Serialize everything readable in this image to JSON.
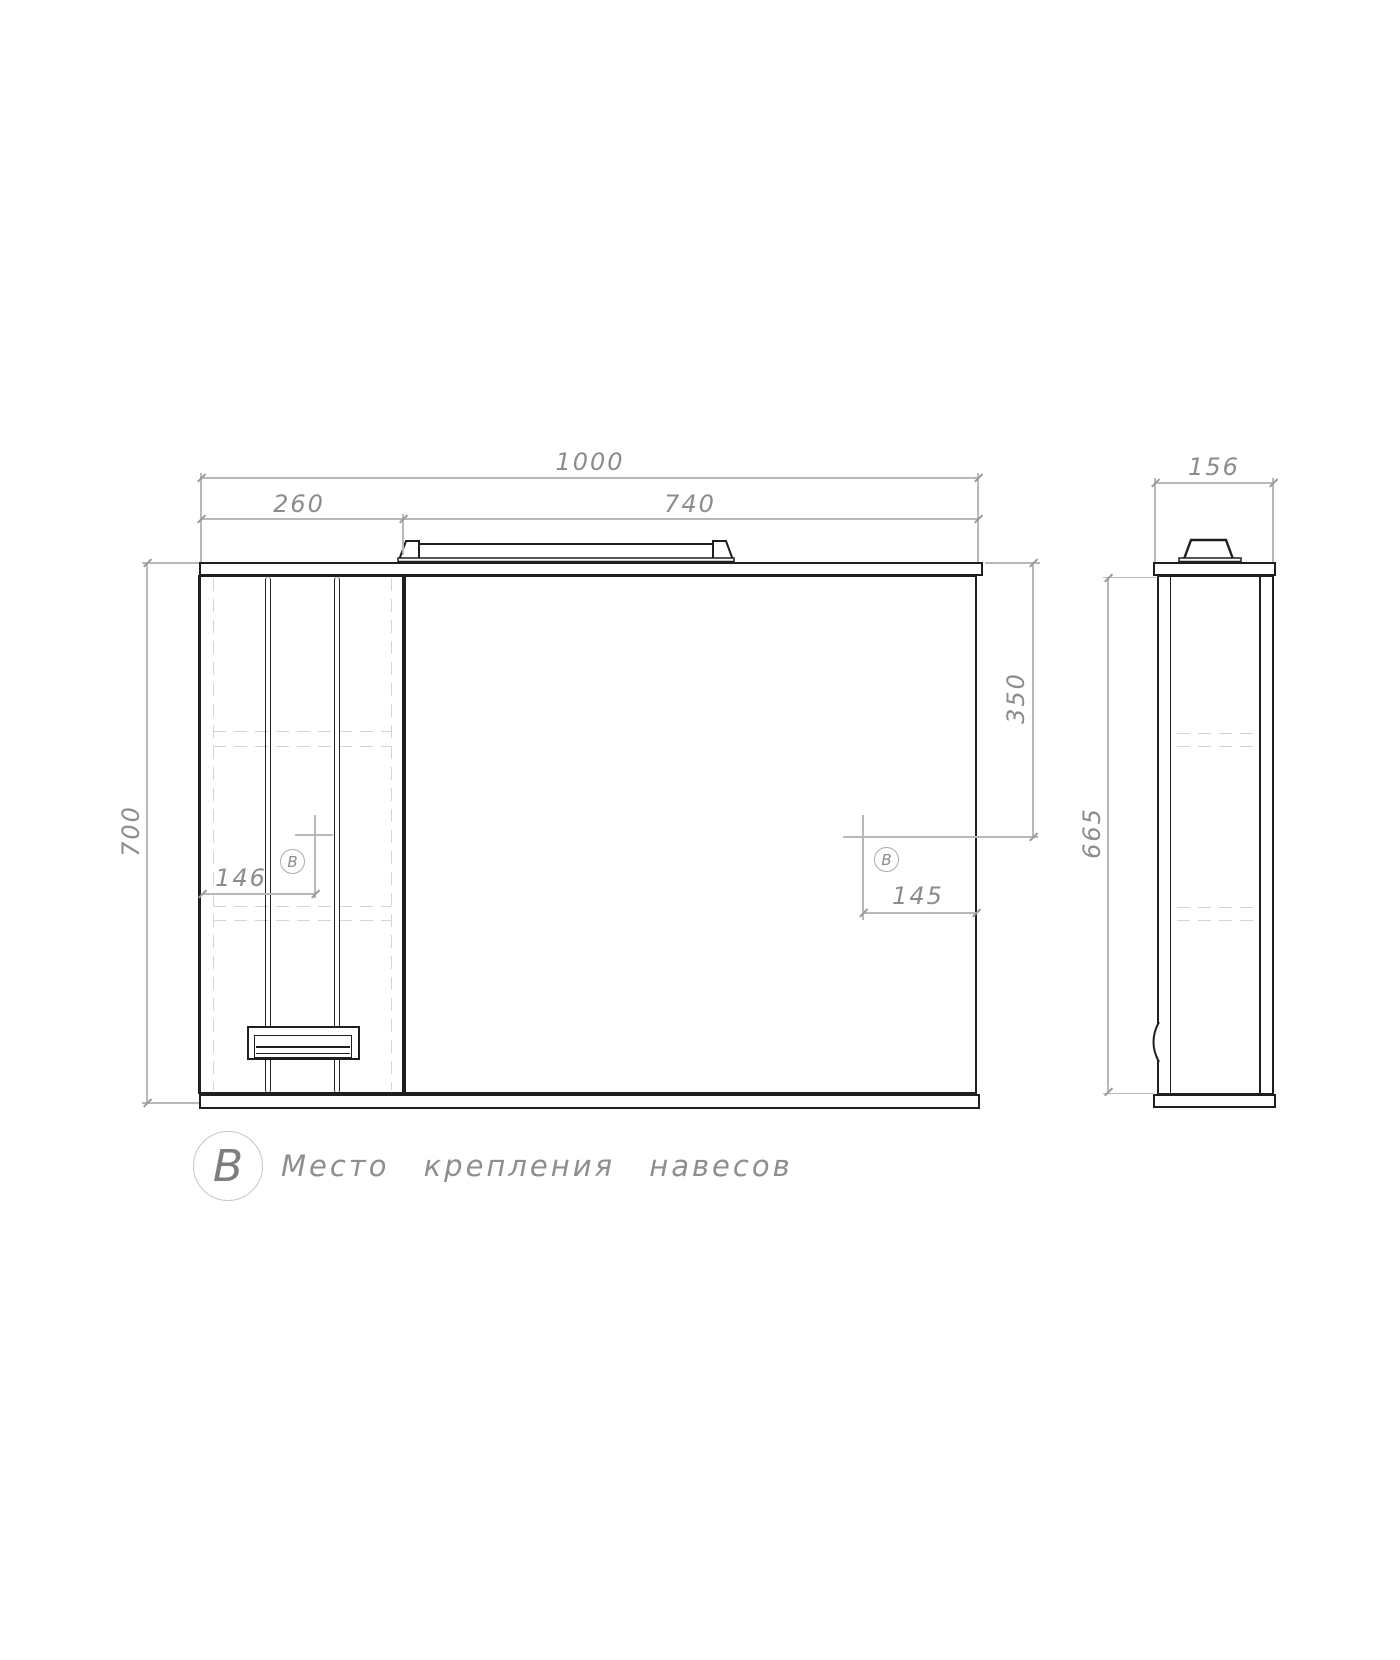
{
  "colors": {
    "object_line": "#1f1f1f",
    "dim_line": "#b5b9b9",
    "dim_text": "#8c8c8c",
    "hidden_line": "#d4d4d4",
    "background": "#ffffff"
  },
  "front_view": {
    "dim_width_total": "1000",
    "dim_width_door": "260",
    "dim_width_mirror": "740",
    "dim_height": "700",
    "dim_hanger_from_top": "350",
    "dim_hanger_left_offset": "146",
    "dim_hanger_right_offset": "145",
    "marker_left": "B",
    "marker_right": "B"
  },
  "side_view": {
    "dim_depth": "156",
    "dim_height": "665"
  },
  "legend": {
    "marker": "B",
    "label": "Место крепления навесов"
  }
}
